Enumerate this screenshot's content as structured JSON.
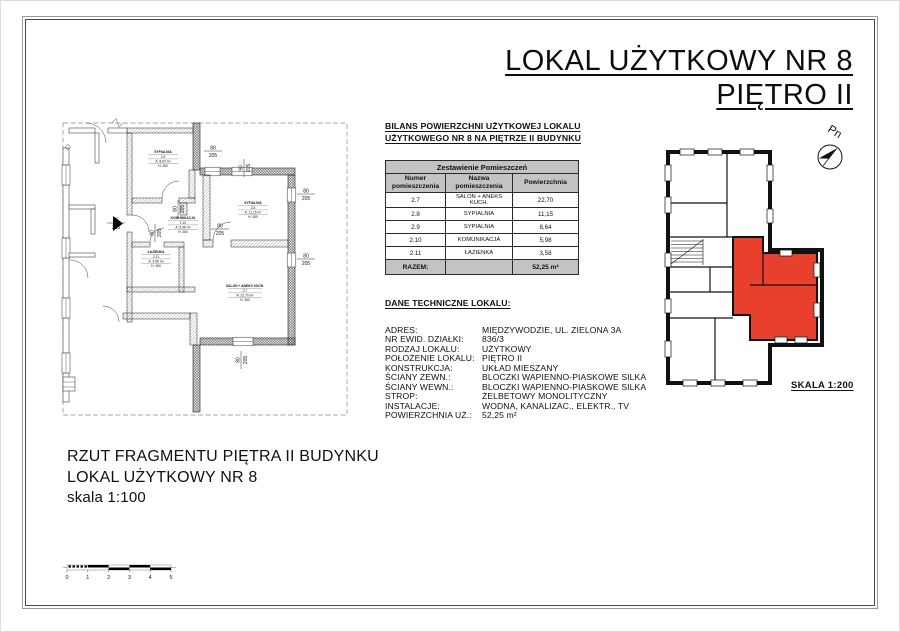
{
  "page": {
    "title_line1": "LOKAL UŻYTKOWY NR 8",
    "title_line2": "PIĘTRO II"
  },
  "balance": {
    "heading_line1": "BILANS POWIERZCHNI UŻYTKOWEJ LOKALU",
    "heading_line2": "UŻYTKOWEGO NR 8 NA PIĘTRZE II BUDYNKU"
  },
  "room_table": {
    "title": "Zestawienie Pomieszczeń",
    "col_num": "Numer pomieszczenia",
    "col_name": "Nazwa pomieszczenia",
    "col_area": "Powierzchnia",
    "rows": [
      {
        "num": "2.7",
        "name": "SALON + ANEKS KUCH.",
        "area": "22,70"
      },
      {
        "num": "2.8",
        "name": "SYPIALNIA",
        "area": "11,15"
      },
      {
        "num": "2.9",
        "name": "SYPIALNIA",
        "area": "8,64"
      },
      {
        "num": "2.10",
        "name": "KOMUNIKACJA",
        "area": "5,98"
      },
      {
        "num": "2.11",
        "name": "ŁAZIENKA",
        "area": "3,58"
      }
    ],
    "total_label": "RAZEM:",
    "total_value": "52,25 m²",
    "header_bg": "#c3c3c3"
  },
  "technical": {
    "heading": "DANE TECHNICZNE LOKALU:",
    "rows": [
      {
        "label": "ADRES:",
        "value": "MIĘDZYWODZIE, UL. ZIELONA 3A"
      },
      {
        "label": "NR EWID. DZIAŁKI:",
        "value": "836/3"
      },
      {
        "label": "RODZAJ LOKALU:",
        "value": "UŻYTKOWY"
      },
      {
        "label": "POŁOŻENIE LOKALU:",
        "value": "PIĘTRO II"
      },
      {
        "label": "KONSTRUKCJA:",
        "value": "UKŁAD MIESZANY"
      },
      {
        "label": "ŚCIANY ZEWN.:",
        "value": "BLOCZKI WAPIENNO-PIASKOWE SILKA"
      },
      {
        "label": "ŚCIANY WEWN.:",
        "value": "BLOCZKI WAPIENNO-PIASKOWE SILKA"
      },
      {
        "label": "STROP:",
        "value": "ŻELBETOWY MONOLITYCZNY"
      },
      {
        "label": "INSTALACJE:",
        "value": "WODNA, KANALIZAC., ELEKTR., TV"
      },
      {
        "label": "POWIERZCHNIA UŻ.:",
        "value": "52,25 m²"
      }
    ]
  },
  "caption": {
    "line1": "RZUT FRAGMENTU PIĘTRA II BUDYNKU",
    "line2": "LOKAL UŻYTKOWY NR 8",
    "line3": "skala 1:100"
  },
  "key_plan": {
    "north_label": "Pn",
    "scale_label": "SKALA 1:200",
    "unit_color": "#e8402c"
  },
  "floor_plan": {
    "rooms": {
      "salon": {
        "name": "SALON + ANEKS KUCH.",
        "number": "2.7",
        "area": "A: 22,70 m²",
        "height": "H: 260"
      },
      "syp28": {
        "name": "SYPIALNIA",
        "number": "2.8",
        "area": "A: 11,15 m²",
        "height": "H: 260"
      },
      "syp29": {
        "name": "SYPIALNIA",
        "number": "2.9",
        "area": "A: 8,64 m²",
        "height": "H: 260"
      },
      "kom": {
        "name": "KOMUNIKACJA",
        "number": "2.10",
        "area": "A: 5,98 m²",
        "height": "H: 260"
      },
      "laz": {
        "name": "ŁAZIENKA",
        "number": "2.11",
        "area": "A: 3,58 m²",
        "height": "H: 260"
      }
    },
    "dims": {
      "w80": "80",
      "w90": "90",
      "w95": "95",
      "h205": "205"
    },
    "scale_bar": [
      "0",
      "1",
      "2",
      "3",
      "4",
      "5"
    ]
  }
}
